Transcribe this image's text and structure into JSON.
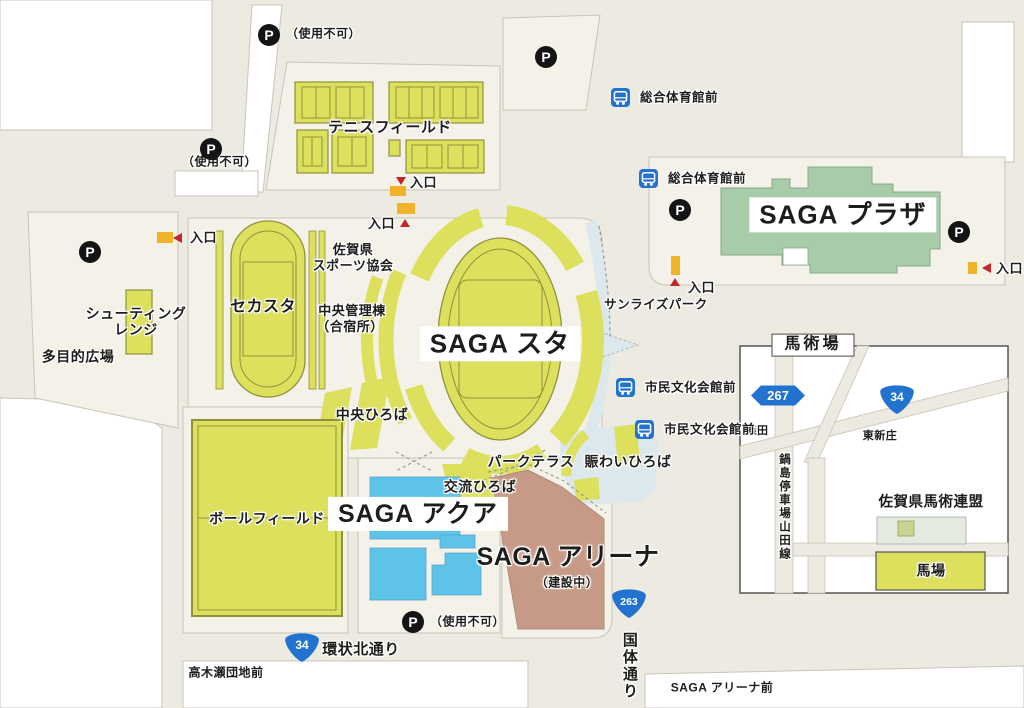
{
  "colors": {
    "road": "#edeae1",
    "parcel": "#f4f1e8",
    "outline": "#c8c4b8",
    "green": "#dce05c",
    "olive": "#8f923c",
    "plaza": "#a8cbaa",
    "aqua": "#5ec3e8",
    "brown": "#c79a88",
    "canal": "#dce8ec",
    "bus": "#2273cf",
    "red": "#c1272d",
    "yellow": "#f1b32b",
    "ink": "#1d1d1b"
  },
  "icons": {
    "parking": "P",
    "bus": "bus-pictogram"
  },
  "labels": [
    {
      "id": "tennis-field",
      "t": "テニスフィールド",
      "x": 390,
      "y": 128,
      "fs": 15
    },
    {
      "id": "sekasuta",
      "t": "セカスタ",
      "x": 263,
      "y": 308,
      "fs": 16
    },
    {
      "id": "saga-sta",
      "t": "SAGA スタ",
      "x": 500,
      "y": 344,
      "fs": 26,
      "box": true
    },
    {
      "id": "sports-assoc-1",
      "t": "佐賀県",
      "x": 353,
      "y": 250,
      "fs": 13
    },
    {
      "id": "sports-assoc-2",
      "t": "スポーツ協会",
      "x": 353,
      "y": 266,
      "fs": 13
    },
    {
      "id": "kanri-1",
      "t": "中央管理棟",
      "x": 352,
      "y": 311,
      "fs": 13
    },
    {
      "id": "kanri-2",
      "t": "（合宿所）",
      "x": 350,
      "y": 327,
      "fs": 13
    },
    {
      "id": "chuo-hiroba",
      "t": "中央ひろば",
      "x": 372,
      "y": 415,
      "fs": 14
    },
    {
      "id": "shooting-1",
      "t": "シューティング",
      "x": 136,
      "y": 314,
      "fs": 14
    },
    {
      "id": "shooting-2",
      "t": "レンジ",
      "x": 136,
      "y": 330,
      "fs": 14
    },
    {
      "id": "tamokuteki",
      "t": "多目的広場",
      "x": 78,
      "y": 357,
      "fs": 14
    },
    {
      "id": "ball-field",
      "t": "ボールフィールド",
      "x": 267,
      "y": 519,
      "fs": 14
    },
    {
      "id": "saga-aqua",
      "t": "SAGA アクア",
      "x": 418,
      "y": 514,
      "fs": 25,
      "box": true
    },
    {
      "id": "koryu-hiroba",
      "t": "交流ひろば",
      "x": 480,
      "y": 487,
      "fs": 14
    },
    {
      "id": "park-terrace",
      "t": "パークテラス",
      "x": 531,
      "y": 462,
      "fs": 14
    },
    {
      "id": "nigiwai-hiroba",
      "t": "賑わいひろば",
      "x": 628,
      "y": 462,
      "fs": 14
    },
    {
      "id": "saga-arena",
      "t": "SAGA アリーナ",
      "x": 568,
      "y": 557,
      "fs": 25
    },
    {
      "id": "arena-note",
      "t": "（建設中）",
      "x": 567,
      "y": 583,
      "fs": 12
    },
    {
      "id": "saga-plaza",
      "t": "SAGA プラザ",
      "x": 843,
      "y": 215,
      "fs": 26,
      "box": true
    },
    {
      "id": "sunrise-park",
      "t": "サンライズパーク",
      "x": 656,
      "y": 305,
      "fs": 12.5
    },
    {
      "id": "kanjo-kita-dori",
      "t": "環状北通り",
      "x": 361,
      "y": 650,
      "fs": 15
    },
    {
      "id": "kokutai-dori",
      "t": "国体通り",
      "x": 629,
      "y": 632,
      "fs": 15,
      "vert": true
    },
    {
      "id": "takakise-danchi-mae",
      "t": "高木瀬団地前",
      "x": 226,
      "y": 673,
      "fs": 12
    },
    {
      "id": "saga-arena-mae",
      "t": "SAGA アリーナ前",
      "x": 722,
      "y": 688,
      "fs": 12
    },
    {
      "id": "inset-title",
      "t": "馬術場",
      "x": 813,
      "y": 345,
      "fs": 16,
      "box2": true
    },
    {
      "id": "morita",
      "t": "森田",
      "x": 757,
      "y": 432,
      "fs": 11
    },
    {
      "id": "higashi-shinjo",
      "t": "東新庄",
      "x": 880,
      "y": 437,
      "fs": 11
    },
    {
      "id": "nabeshima-line",
      "t": "鍋島停車場山田線",
      "x": 784,
      "y": 453,
      "fs": 11.5,
      "vert": true
    },
    {
      "id": "equestrian-federation",
      "t": "佐賀県馬術連盟",
      "x": 931,
      "y": 503,
      "fs": 14.5
    },
    {
      "id": "baba",
      "t": "馬場",
      "x": 931,
      "y": 571,
      "fs": 14
    }
  ],
  "parkings": [
    {
      "id": "p-north",
      "x": 258,
      "y": 24,
      "note": "（使用不可）",
      "nx": 286,
      "ny": 34
    },
    {
      "id": "p-northwest",
      "x": 200,
      "y": 138,
      "note": "（使用不可）",
      "nx": 182,
      "ny": 162
    },
    {
      "id": "p-west",
      "x": 79,
      "y": 241
    },
    {
      "id": "p-tennis-east",
      "x": 535,
      "y": 46
    },
    {
      "id": "p-plaza-west",
      "x": 669,
      "y": 199
    },
    {
      "id": "p-plaza-east",
      "x": 948,
      "y": 221
    },
    {
      "id": "p-aqua",
      "x": 402,
      "y": 611,
      "note": "（使用不可）",
      "nx": 430,
      "ny": 622
    }
  ],
  "entrances": [
    {
      "id": "entrance-tennis",
      "label": "入口",
      "bar": [
        390,
        186,
        16,
        10
      ],
      "tri": "down",
      "tx": 396,
      "ty": 177,
      "lx": 410,
      "ly": 183
    },
    {
      "id": "entrance-stadium",
      "label": "入口",
      "bar": [
        397,
        203,
        18,
        11
      ],
      "tri": "up",
      "tx": 400,
      "ty": 219,
      "lx": 368,
      "ly": 224
    },
    {
      "id": "entrance-west",
      "label": "入口",
      "bar": [
        157,
        232,
        16,
        11
      ],
      "tri": "left",
      "tx": 173,
      "ty": 233,
      "lx": 190,
      "ly": 238
    },
    {
      "id": "entrance-plaza-south",
      "label": "入口",
      "bar": [
        671,
        256,
        9,
        19
      ],
      "tri": "up",
      "tx": 670,
      "ty": 278,
      "lx": 688,
      "ly": 288
    },
    {
      "id": "entrance-plaza-east",
      "label": "入口",
      "bar": [
        968,
        262,
        9,
        12
      ],
      "tri": "left",
      "tx": 982,
      "ty": 263,
      "lx": 996,
      "ly": 269
    }
  ],
  "bus_stops": [
    {
      "id": "bus-sogo-taiikukan-1",
      "label": "総合体育館前",
      "x": 611,
      "y": 88,
      "lx": 640,
      "ly": 98
    },
    {
      "id": "bus-sogo-taiikukan-2",
      "label": "総合体育館前",
      "x": 639,
      "y": 169,
      "lx": 668,
      "ly": 179
    },
    {
      "id": "bus-shimin-bunka-1",
      "label": "市民文化会館前",
      "x": 616,
      "y": 378,
      "lx": 645,
      "ly": 388
    },
    {
      "id": "bus-shimin-bunka-2",
      "label": "市民文化会館前",
      "x": 635,
      "y": 420,
      "lx": 664,
      "ly": 430
    }
  ],
  "route_shields": [
    {
      "id": "route-34-main",
      "type": "national",
      "num": "34",
      "x": 302,
      "y": 650
    },
    {
      "id": "route-263",
      "type": "national",
      "num": "263",
      "x": 629,
      "y": 606
    },
    {
      "id": "route-267-inset",
      "type": "prefectural",
      "num": "267",
      "x": 778,
      "y": 398
    },
    {
      "id": "route-34-inset",
      "type": "national",
      "num": "34",
      "x": 897,
      "y": 402
    }
  ]
}
